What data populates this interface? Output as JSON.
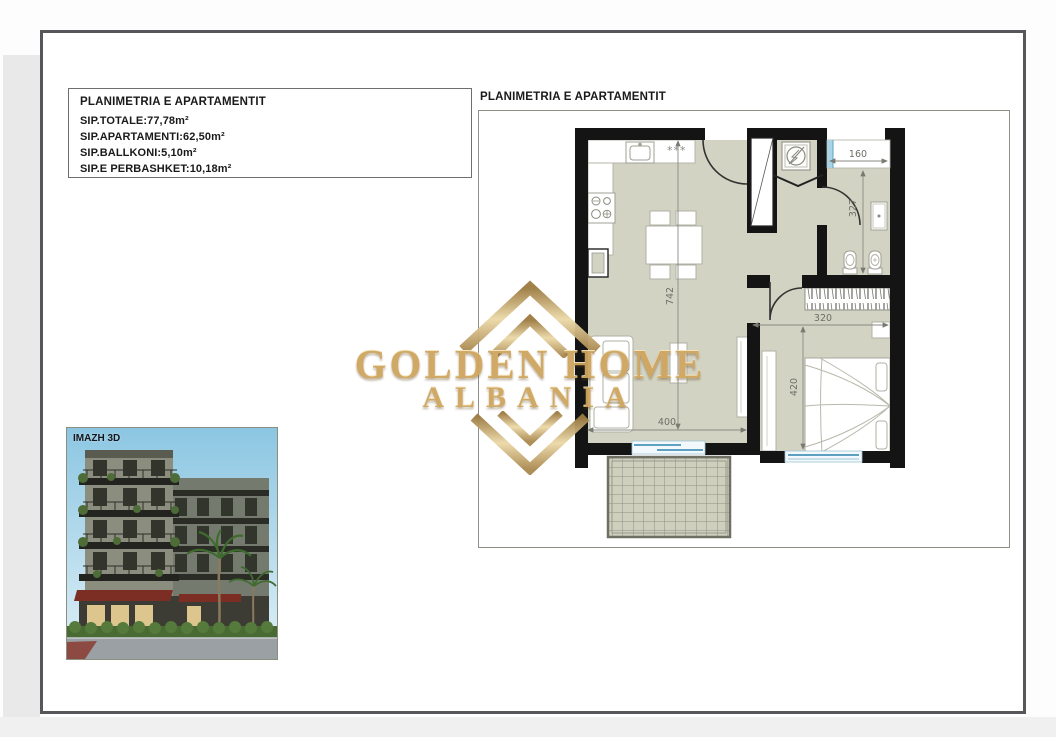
{
  "document": {
    "info_box": {
      "title": "PLANIMETRIA E APARTAMENTIT",
      "lines": [
        "SIP.TOTALE:77,78m²",
        "SIP.APARTAMENTI:62,50m²",
        "SIP.BALLKONI:5,10m²",
        "SIP.E PERBASHKET:10,18m²"
      ]
    },
    "plan": {
      "title": "PLANIMETRIA E APARTAMENTIT",
      "dims": {
        "bath_width": "160",
        "bath_depth": "327",
        "living_length": "742",
        "bedroom_width": "320",
        "bedroom_depth": "420",
        "living_width": "400"
      },
      "kitchen_mark": "***",
      "colors": {
        "floor": "#d3d3c3",
        "wall": "#141414",
        "window_blue": "#5ea0bf",
        "dimension_gray": "#6e6e68"
      }
    },
    "watermark": {
      "line1": "GOLDEN HOME",
      "line2": "ALBANIA",
      "gold_dark": "#a8854a",
      "gold_mid": "#cfa55e",
      "gold_light": "#ecd9a8"
    },
    "photo": {
      "label": "IMAZH 3D"
    }
  }
}
